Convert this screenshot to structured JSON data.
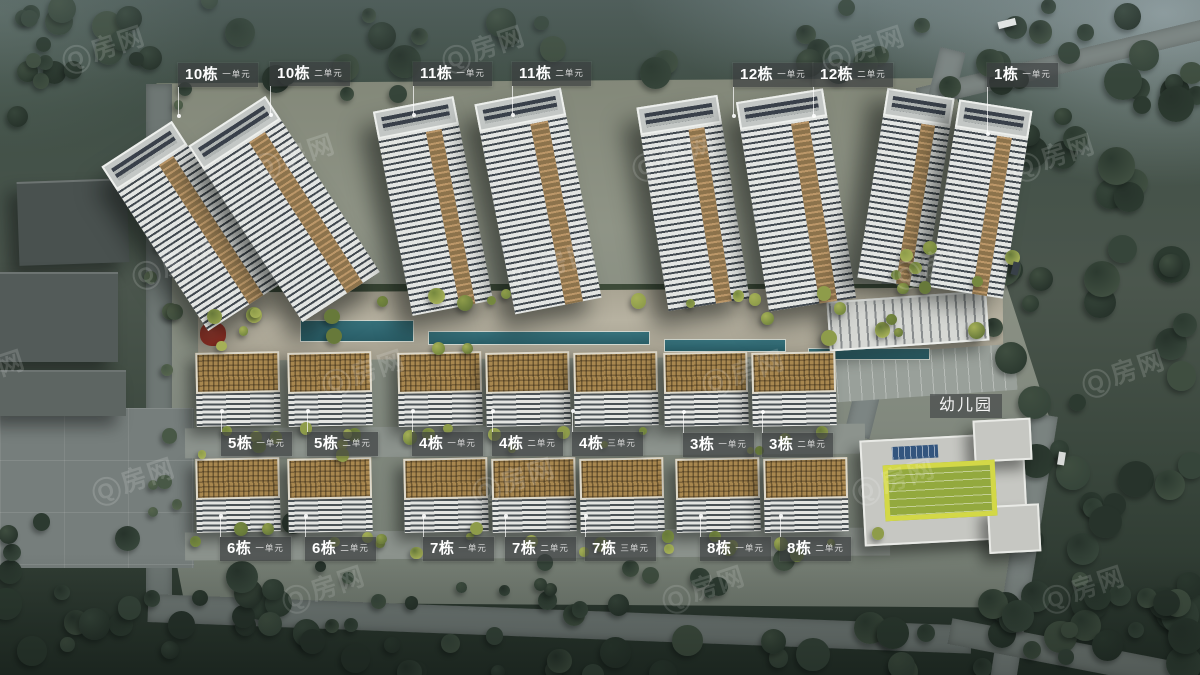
{
  "watermark": {
    "text": "Q房网"
  },
  "kindergarten_label": "幼儿园",
  "building_labels": [
    {
      "building": "10栋",
      "unit": "一单元",
      "x": 178,
      "y": 63,
      "leader": "down"
    },
    {
      "building": "10栋",
      "unit": "二单元",
      "x": 270,
      "y": 62,
      "leader": "down"
    },
    {
      "building": "11栋",
      "unit": "一单元",
      "x": 413,
      "y": 62,
      "leader": "down"
    },
    {
      "building": "11栋",
      "unit": "二单元",
      "x": 512,
      "y": 62,
      "leader": "down"
    },
    {
      "building": "12栋",
      "unit": "一单元",
      "x": 733,
      "y": 63,
      "leader": "down"
    },
    {
      "building": "12栋",
      "unit": "二单元",
      "x": 813,
      "y": 63,
      "leader": "down"
    },
    {
      "building": "1栋",
      "unit": "一单元",
      "x": 987,
      "y": 63,
      "leader": "down-long"
    },
    {
      "building": "5栋",
      "unit": "一单元",
      "x": 221,
      "y": 432,
      "leader": "up"
    },
    {
      "building": "5栋",
      "unit": "二单元",
      "x": 307,
      "y": 432,
      "leader": "up"
    },
    {
      "building": "4栋",
      "unit": "一单元",
      "x": 412,
      "y": 432,
      "leader": "up"
    },
    {
      "building": "4栋",
      "unit": "二单元",
      "x": 492,
      "y": 432,
      "leader": "up"
    },
    {
      "building": "4栋",
      "unit": "三单元",
      "x": 572,
      "y": 432,
      "leader": "up"
    },
    {
      "building": "3栋",
      "unit": "一单元",
      "x": 683,
      "y": 433,
      "leader": "up"
    },
    {
      "building": "3栋",
      "unit": "二单元",
      "x": 762,
      "y": 433,
      "leader": "up"
    },
    {
      "building": "6栋",
      "unit": "一单元",
      "x": 220,
      "y": 537,
      "leader": "up"
    },
    {
      "building": "6栋",
      "unit": "二单元",
      "x": 305,
      "y": 537,
      "leader": "up"
    },
    {
      "building": "7栋",
      "unit": "一单元",
      "x": 423,
      "y": 537,
      "leader": "up"
    },
    {
      "building": "7栋",
      "unit": "二单元",
      "x": 505,
      "y": 537,
      "leader": "up"
    },
    {
      "building": "7栋",
      "unit": "三单元",
      "x": 585,
      "y": 537,
      "leader": "up"
    },
    {
      "building": "8栋",
      "unit": "一单元",
      "x": 700,
      "y": 537,
      "leader": "up"
    },
    {
      "building": "8栋",
      "unit": "二单元",
      "x": 780,
      "y": 537,
      "leader": "up"
    }
  ]
}
